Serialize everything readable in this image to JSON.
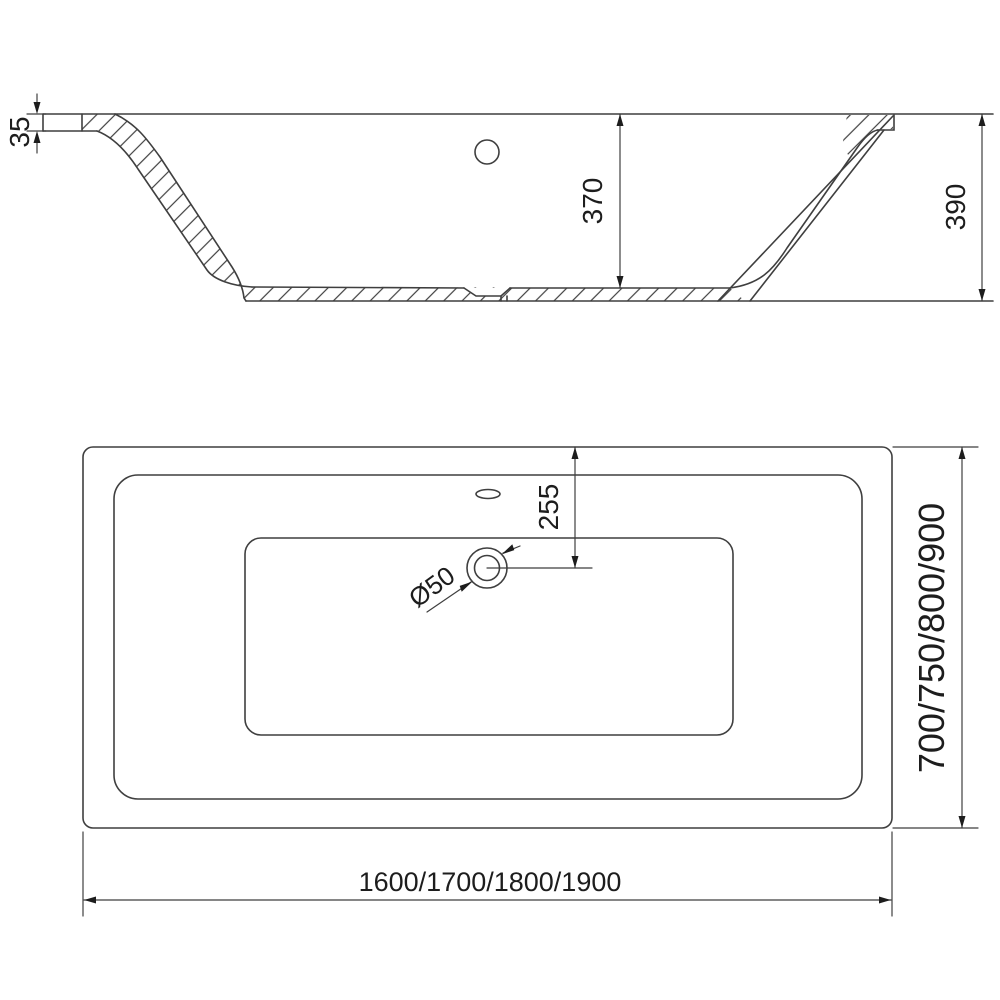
{
  "drawing": {
    "name": "Bathtub dimensional technical drawing, side section and plan view",
    "section_view": {
      "rim_thickness": "35",
      "inner_depth": "370",
      "total_height": "390"
    },
    "plan_view": {
      "drain_offset": "255",
      "drain_diameter": "Ø50",
      "width_options": "700/750/800/900",
      "length_options": "1600/1700/1800/1900"
    }
  },
  "style": {
    "line_color": "#3f3f3f",
    "text_color": "#1d1d1d",
    "background": "#ffffff"
  }
}
